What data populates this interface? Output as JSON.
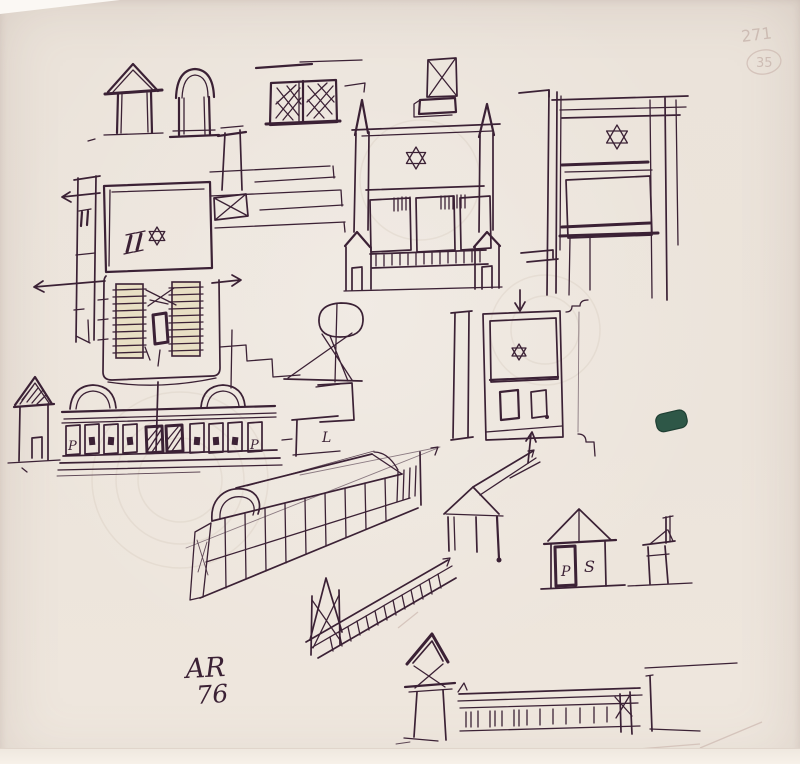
{
  "artwork": {
    "signature": {
      "initials": "AR",
      "year": "76"
    },
    "pencil_annotations": {
      "page_number": "271",
      "circled_number": "35"
    },
    "inscriptions": {
      "arcade_left_letter": "P",
      "arcade_right_letter": "P",
      "wall_letter": "L",
      "hut_door_letter": "P",
      "hut_side_letter": "S"
    },
    "colors": {
      "paper": "#ece4db",
      "ink": "#3b2135",
      "pencil": "#c7b4ac",
      "green_daub": "#2e5747",
      "plan_seating_fill": "#e8dfc4"
    }
  }
}
